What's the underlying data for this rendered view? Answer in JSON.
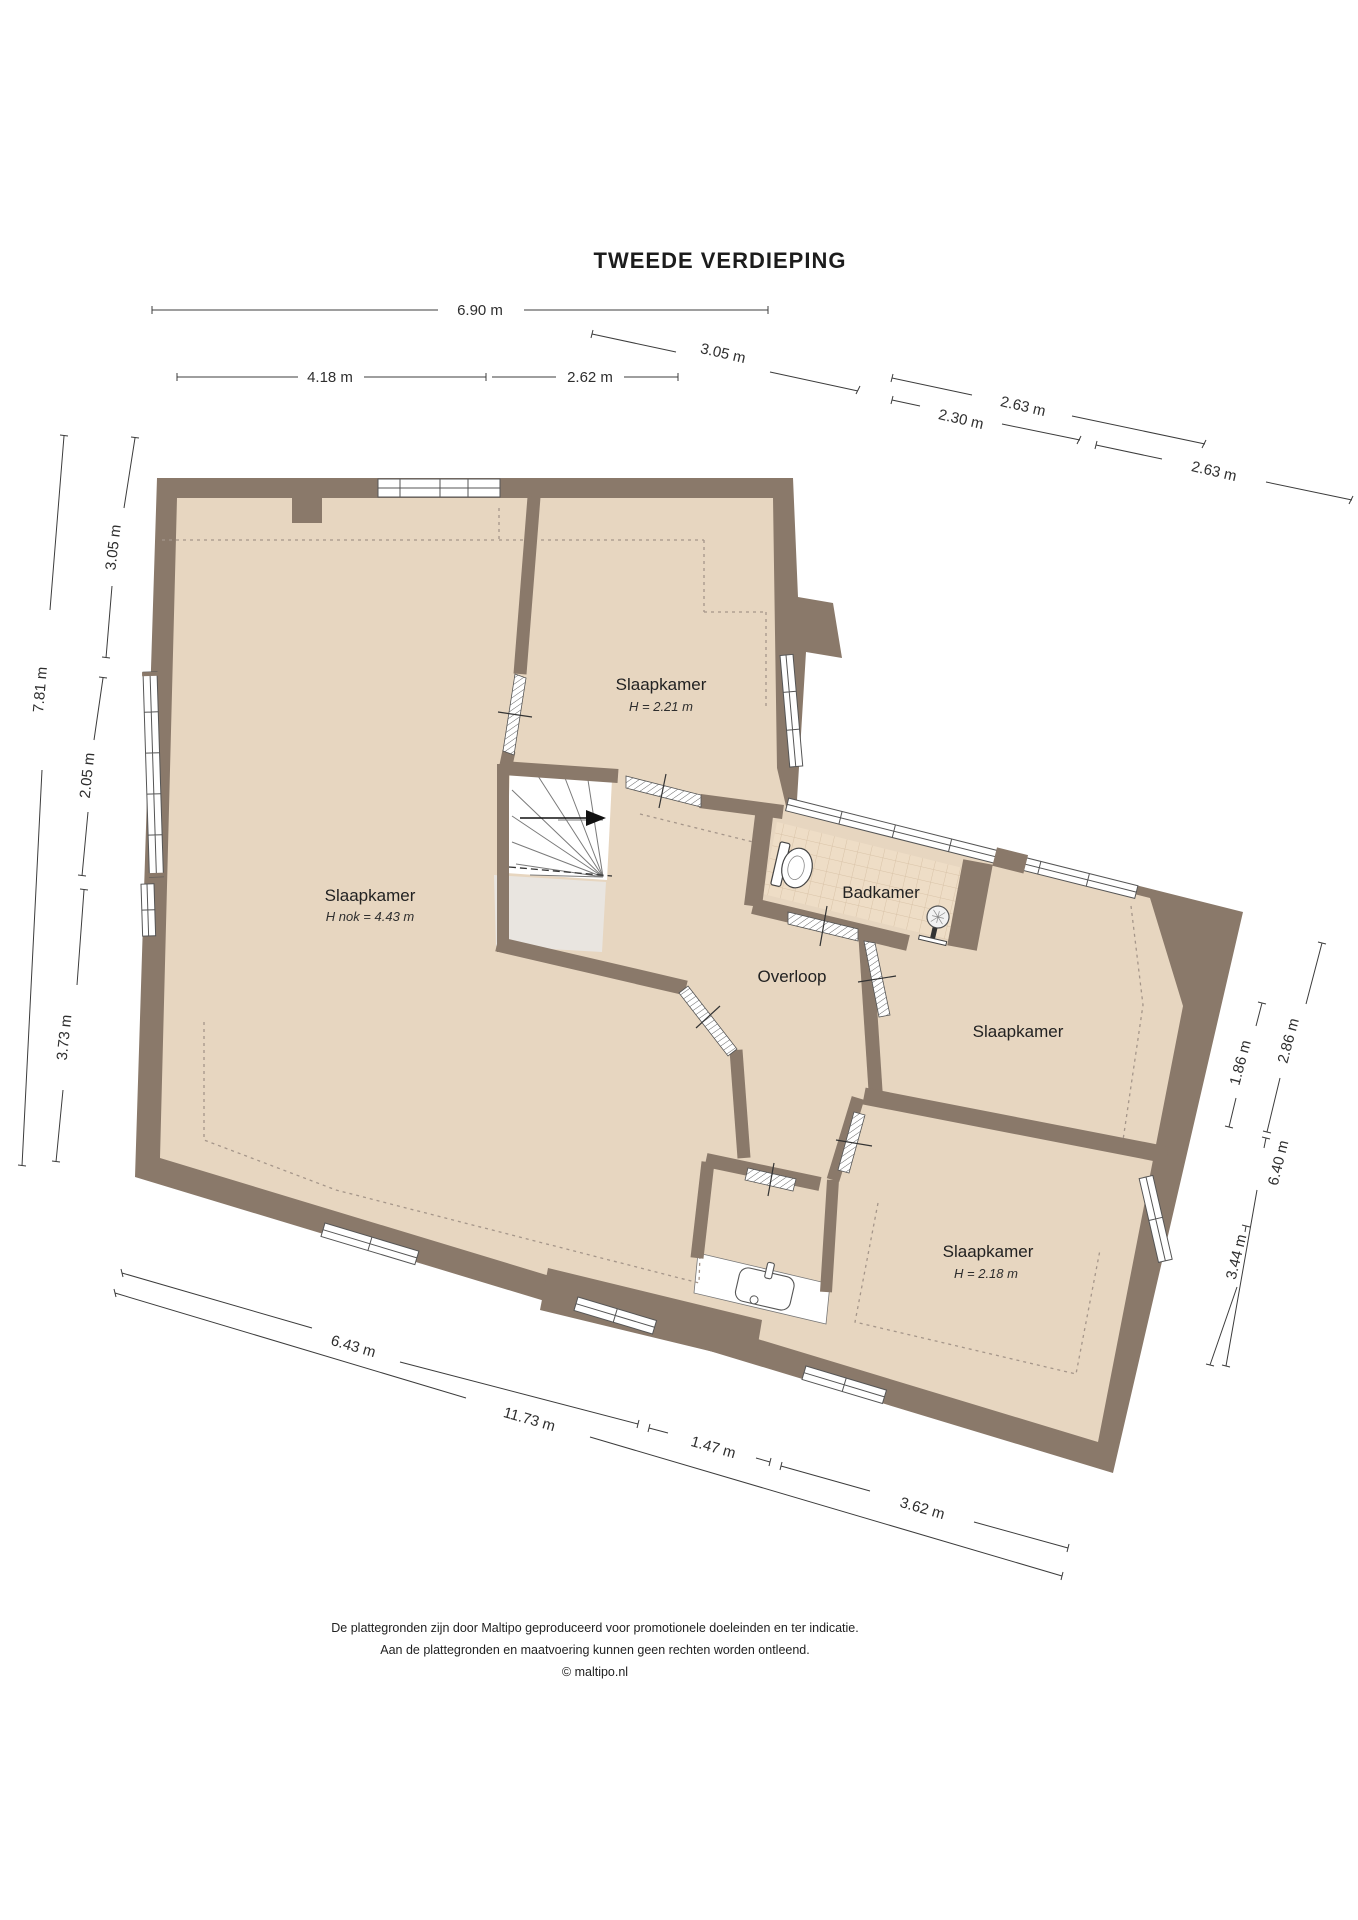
{
  "title": "TWEEDE VERDIEPING",
  "rooms": [
    {
      "label": "Slaapkamer",
      "sub": "H nok = 4.43 m"
    },
    {
      "label": "Slaapkamer",
      "sub": "H = 2.21 m"
    },
    {
      "label": "Badkamer"
    },
    {
      "label": "Overloop"
    },
    {
      "label": "Slaapkamer"
    },
    {
      "label": "Slaapkamer",
      "sub": "H = 2.18 m"
    }
  ],
  "dims": [
    {
      "label": "6.90 m"
    },
    {
      "label": "4.18 m"
    },
    {
      "label": "2.62 m"
    },
    {
      "label": "3.05 m"
    },
    {
      "label": "2.63 m"
    },
    {
      "label": "2.30 m"
    },
    {
      "label": "2.63 m"
    },
    {
      "label": "3.05 m"
    },
    {
      "label": "2.05 m"
    },
    {
      "label": "7.81 m"
    },
    {
      "label": "3.73 m"
    },
    {
      "label": "1.86 m"
    },
    {
      "label": "2.86 m"
    },
    {
      "label": "6.40 m"
    },
    {
      "label": "3.44 m"
    },
    {
      "label": "6.43 m"
    },
    {
      "label": "11.73 m"
    },
    {
      "label": "1.47 m"
    },
    {
      "label": "3.62 m"
    }
  ],
  "footer": {
    "line1": "De plattegronden zijn door Maltipo geproduceerd voor promotionele doeleinden en ter indicatie.",
    "line2": "Aan de plattegronden en maatvoering kunnen geen rechten worden ontleend.",
    "line3": "© maltipo.nl"
  },
  "icons": {
    "shower": "shower-icon",
    "toilet": "toilet-icon",
    "sink": "sink-icon",
    "stairs_arrow": "stairs-direction-arrow-icon"
  },
  "colors": {
    "wall": "#8a796a",
    "floor": "#e7d6c0",
    "tile": "#eeddc6",
    "tile_line": "#d9c3a8",
    "stair_void": "#e9e5e0",
    "dash": "#a5968a",
    "dim_line": "#3c3c3c"
  }
}
